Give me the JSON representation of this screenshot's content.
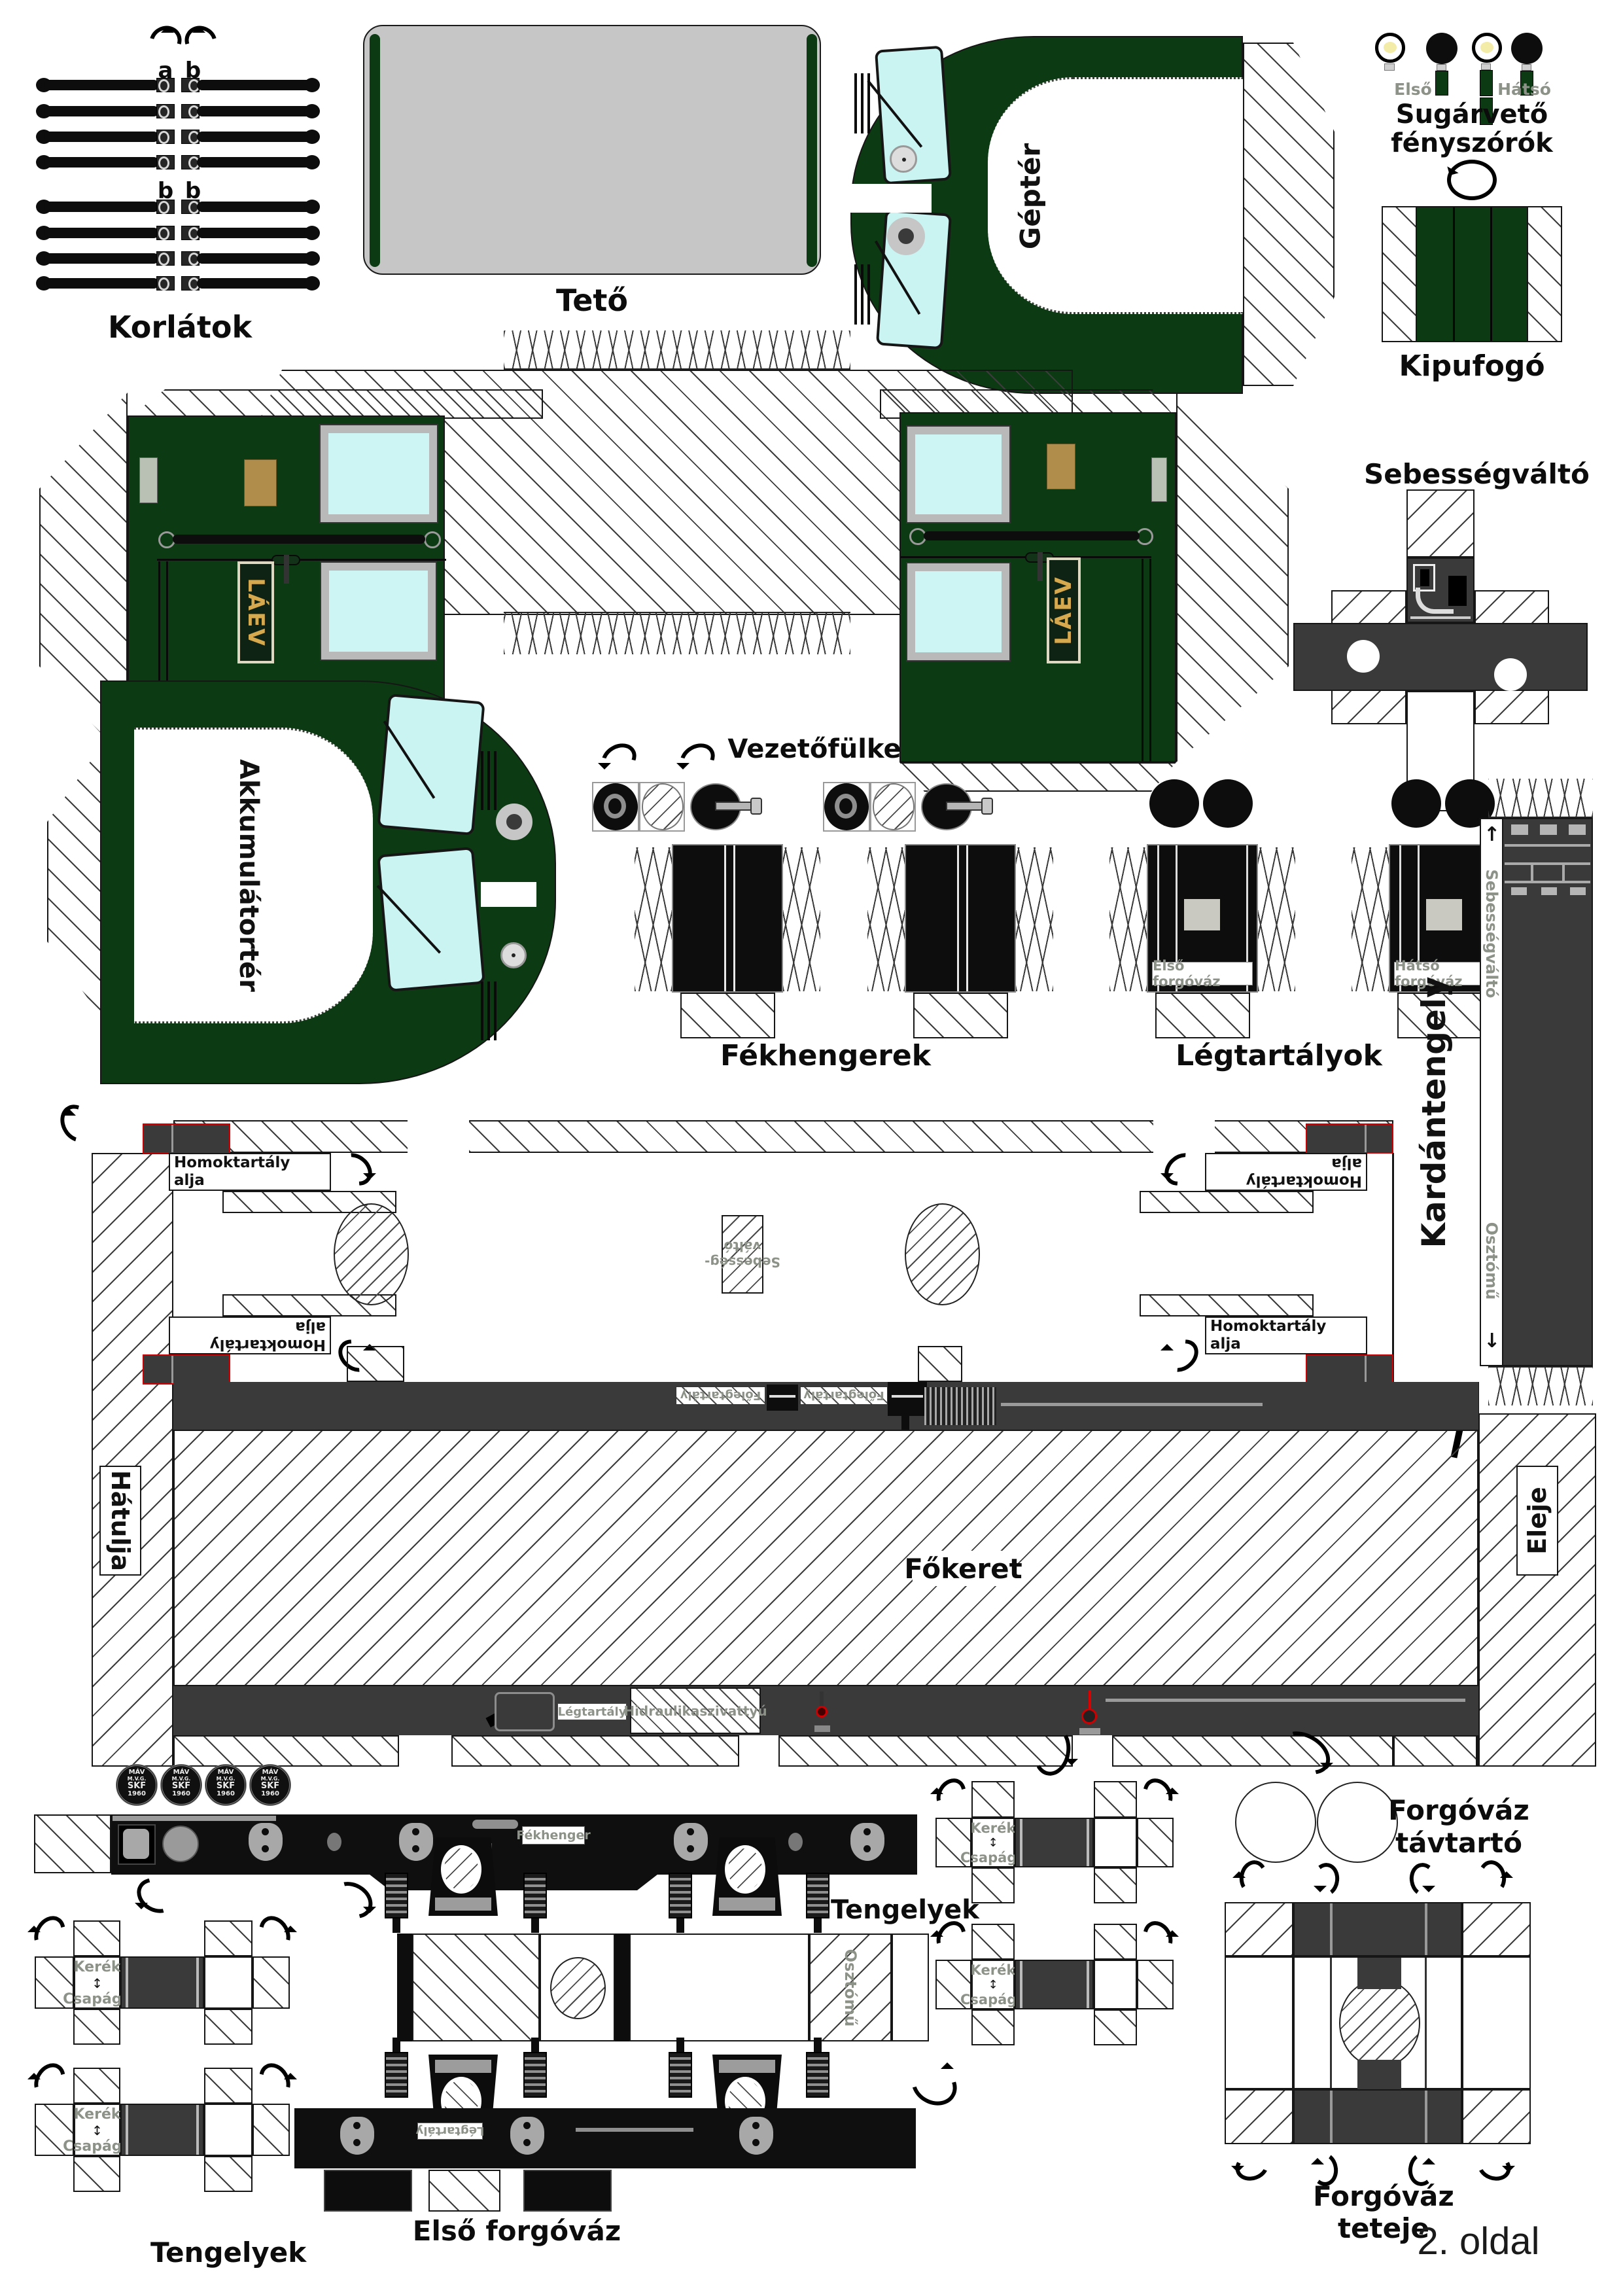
{
  "page": {
    "footer": "2. oldal"
  },
  "colors": {
    "loco_green": "#0c3a12",
    "window_cyan": "#c9f4f2",
    "roof_gray": "#c6c6c6",
    "band_gray": "#3a3a3a",
    "tab_red": "#cc0000",
    "plate_gold": "#d7a94e",
    "small_label_gray": "#8d9288"
  },
  "icons": {
    "up": "↑",
    "down": "↓",
    "updown": "↕"
  },
  "labels": {
    "korlatok": "Korlátok",
    "tab_a": "a",
    "tab_b": "b",
    "teto": "Tető",
    "gepter": "Géptér",
    "headlights_1": "Sugárvető",
    "headlights_2": "fényszórók",
    "elso": "Első",
    "hatso": "Hátsó",
    "kipufogo": "Kipufogó",
    "sebessegvalto": "Sebességváltó",
    "vezetofulke": "Vezetőfülke",
    "laev": "LÁEV",
    "akkumulatorter": "Akkumulátortér",
    "fekhengerek": "Fékhengerek",
    "legtartalyok": "Légtartályok",
    "elso_forgovaz": "Első forgóváz",
    "hatso_forgovaz": "Hátsó forgóváz",
    "kardantengely": "Kardántengely",
    "osztomu": "Osztómű",
    "fokeret": "Főkeret",
    "hatulja": "Hátulja",
    "eleje": "Eleje",
    "homoktartaly_1": "Homoktartály",
    "homoktartaly_2": "alja",
    "sebesseg_1": "Sebesség-",
    "sebesseg_2": "váltó",
    "folegtartaly": "Főlegtartály",
    "legtartaly": "Légtartály",
    "hidraulikaszivattyu": "Hidraulikaszivattyú",
    "fekhenger": "Fékhenger",
    "plate_number": "9111-055",
    "kerek": "Kerék",
    "csapagy": "Csapágy",
    "tengelyek": "Tengelyek",
    "forgovaz_tavtarto_1": "Forgóváz",
    "forgovaz_tavtarto_2": "távtartó",
    "forgovaz_teteje": "Forgóváz teteje",
    "skf_1": "MÁV",
    "skf_2": "M.V.G.",
    "skf_3": "SKF",
    "skf_4": "1960"
  }
}
